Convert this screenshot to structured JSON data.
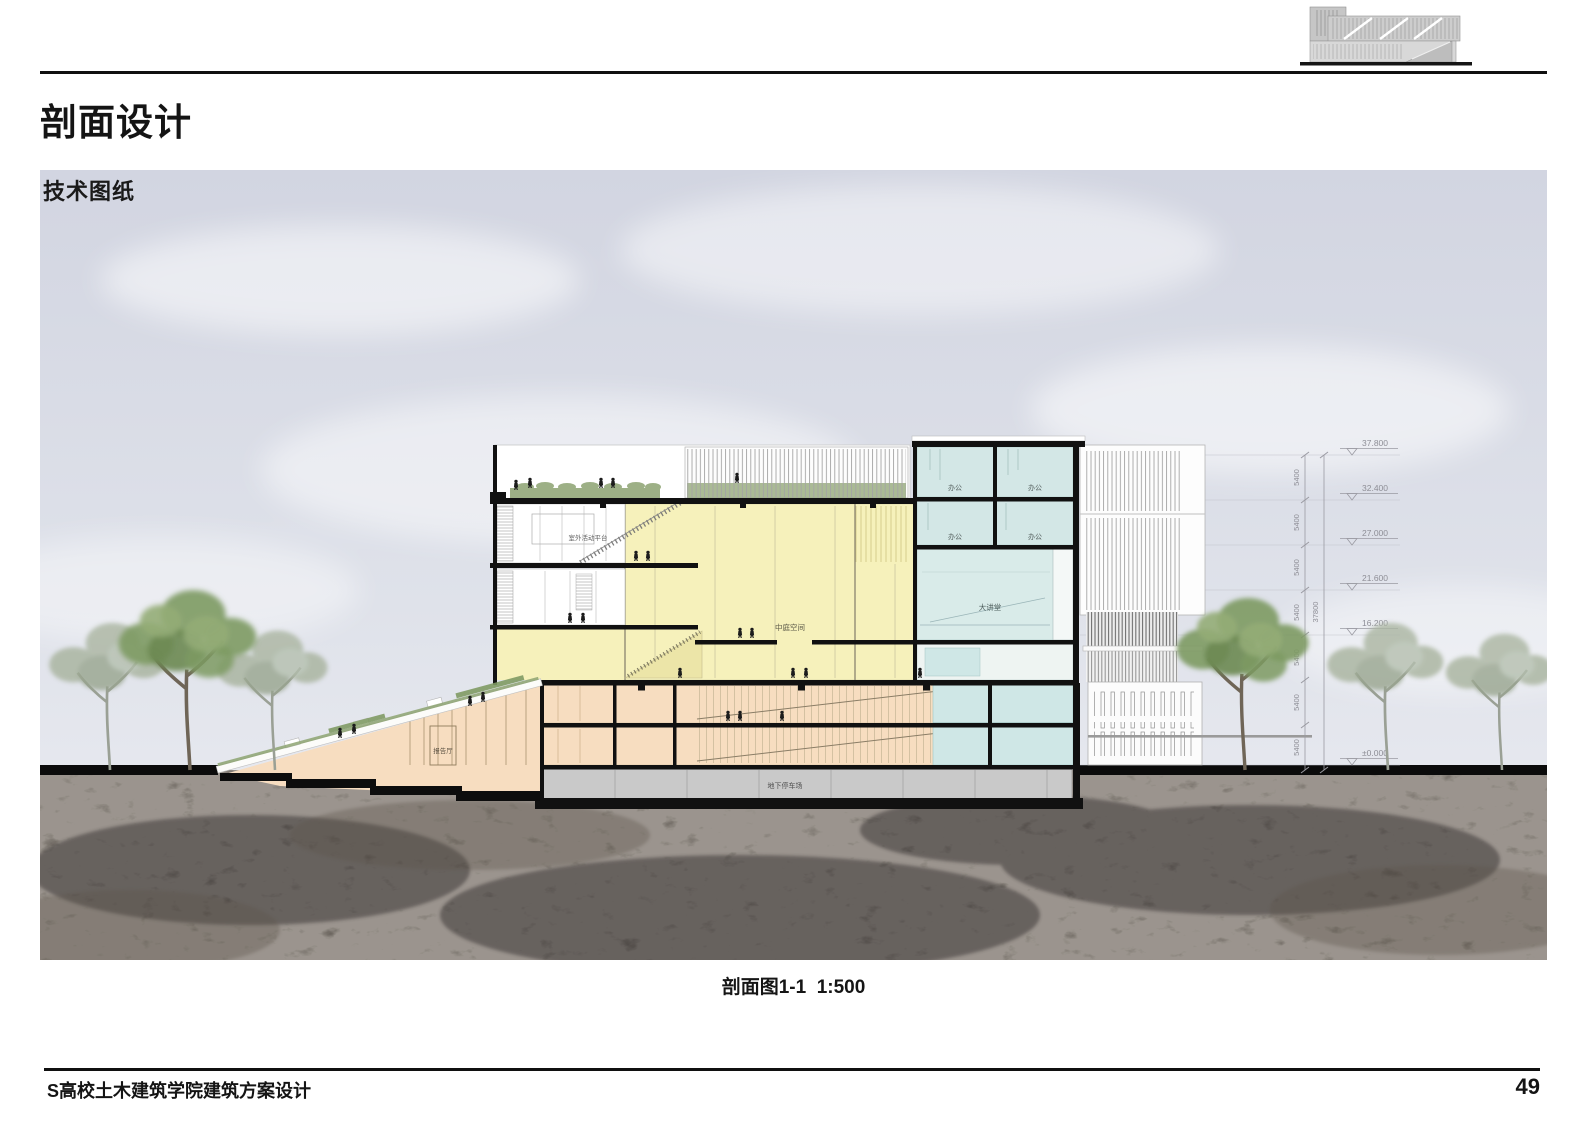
{
  "page": {
    "title": "剖面设计",
    "section_label": "技术图纸",
    "caption": "剖面图1-1  1:500",
    "footer": "S高校土木建筑学院建筑方案设计",
    "page_number": "49"
  },
  "drawing": {
    "rooms": {
      "terrace": "室外活动平台",
      "atrium": "中庭空间",
      "office": "办公",
      "lecture_hall": "大讲堂",
      "report_hall": "报告厅",
      "parking": "地下停车场"
    },
    "dims": {
      "floor_height": "5400",
      "total_height": "37800",
      "levels": [
        "37.800",
        "32.400",
        "27.000",
        "21.600",
        "16.200",
        "±0.000"
      ]
    }
  },
  "colors": {
    "atrium_yellow": "#f6f1bb",
    "office_blue": "#d3e7e6",
    "podium_orange": "#f7ddc0",
    "basement_gray": "#c9c9c9",
    "sky_top": "#d3d6e2",
    "ground_rock": "#413c37",
    "foliage_green": "#7d9a62",
    "slab_black": "#111111"
  }
}
